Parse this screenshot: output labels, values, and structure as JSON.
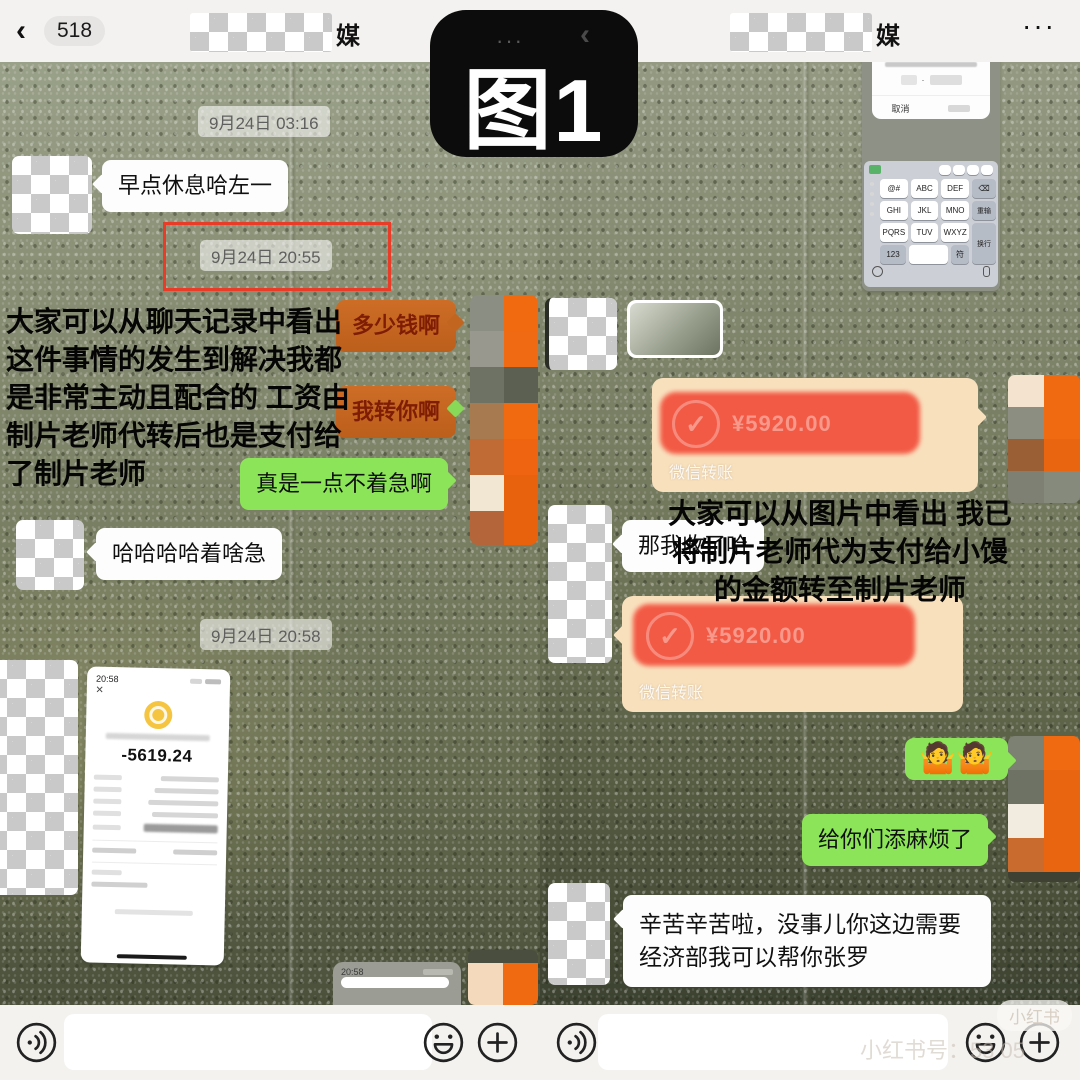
{
  "figure_label": "图1",
  "overlay": {
    "ghost_dots": "···",
    "ghost_chevron": "‹"
  },
  "watermark": {
    "badge": "小红书",
    "id_line": "小红书号：53 05"
  },
  "palette": {
    "wechat_green": "#8ce558",
    "highlight_orange": "#c96a28",
    "transfer_beige": "#f8e0bd",
    "redact_red": "#f2503c",
    "highlight_box_red": "#e83c28",
    "avatar_orange": "#f06a12"
  },
  "left_chat": {
    "header": {
      "back": "‹",
      "badge": "518",
      "title_suffix": "媒"
    },
    "dates": {
      "d1": "9月24日 03:16",
      "d2": "9月24日 20:55",
      "d3": "9月24日 20:58"
    },
    "messages": {
      "m1": "早点休息哈左一",
      "m2": "多少钱啊",
      "m3": "我转你啊",
      "m4": "真是一点不着急啊",
      "m5": "哈哈哈哈着啥急"
    },
    "annotation": [
      "大家可以从聊天记录中看出",
      "这件事情的发生到解决我都",
      "是非常主动且配合的 工资由",
      "制片老师代转后也是支付给",
      "了制片老师"
    ],
    "receipt": {
      "status_time": "20:58",
      "close": "×",
      "amount": "-5619.24"
    },
    "partial_screenshot_time": "20:58"
  },
  "right_chat": {
    "header": {
      "title_suffix": "媒",
      "menu": "···"
    },
    "keyboard_shot": {
      "cancel": "取消",
      "keys": [
        "@#",
        "ABC",
        "DEF",
        "GHI",
        "JKL",
        "MNO",
        "PQRS",
        "TUV",
        "WXYZ"
      ],
      "side_keys": [
        "⌫",
        "重输",
        "换行"
      ],
      "bottom_keys": [
        "123",
        "符"
      ]
    },
    "messages": {
      "transfer_label": "微信转账",
      "transfer_amount_hint": "¥5920.00",
      "r2": "那我收了哈",
      "r3": "🤷🤷",
      "r4": "给你们添麻烦了",
      "r5": "辛苦辛苦啦，没事儿你这边需要经济部我可以帮你张罗"
    },
    "annotation": [
      "大家可以从图片中看出 我已",
      "将制片老师代为支付给小馒",
      "的金额转至制片老师"
    ]
  }
}
